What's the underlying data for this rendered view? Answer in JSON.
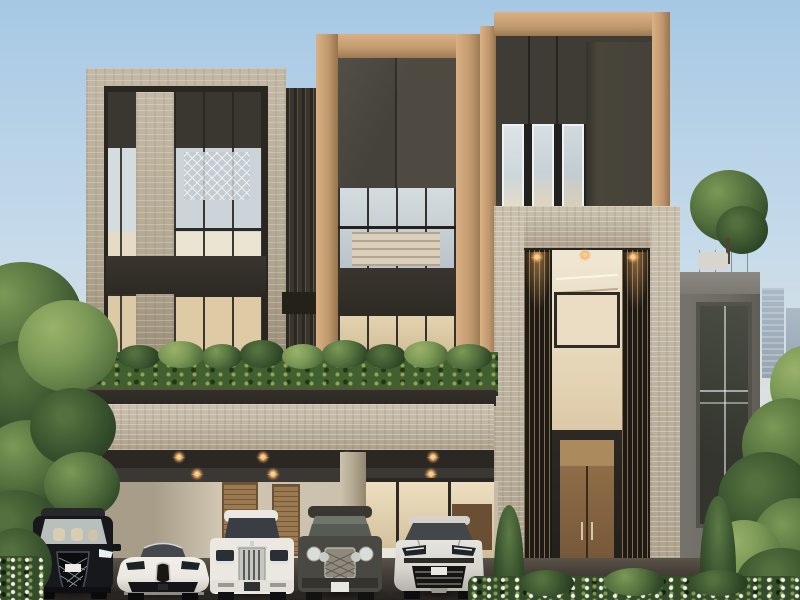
{
  "scene": {
    "title": "Modern three-storey luxury residence exterior with five luxury vehicles parked in the carport",
    "sky": "clear pale-blue daylight sky",
    "background": {
      "left_skyline": "distant high-rise city towers",
      "right_skyline": "distant high-rise city towers"
    },
    "residence": {
      "storeys": 3,
      "materials": [
        "beige concrete window frames",
        "travertine stone bands",
        "charcoal metal panels",
        "bronze metal pilasters",
        "full-height glazing with pale mullions",
        "black vertical slat screens"
      ],
      "features": [
        "left concrete-framed window tower with decorative lattice screen inside",
        "ribbed dark fin wall between towers",
        "bronze-framed central tower with dark panels and gridded windows",
        "bronze-trimmed dark right tower with triple vertical windows",
        "double-height travertine entrance portal",
        "vertical slat screens with warm accent lighting",
        "clipped rooftop hedge planter above carport",
        "travertine carport fascia with recessed warm downlights",
        "wood double entry door with steel pulls",
        "roof terrace at right with glass railing, white planter and tree"
      ]
    },
    "carport": {
      "downlight_count": 10,
      "entry_pendant_light_count": 3,
      "elements": [
        "beige rear wall",
        "wood louver shutters",
        "glazed kitchen wall with warm interior",
        "concrete column"
      ]
    },
    "vehicles": [
      {
        "name": "luxury-minivan",
        "style": "Lexus-LM-type minivan with spindle grille",
        "color": "black",
        "front_plate": "white, unreadable"
      },
      {
        "name": "hypercar",
        "style": "Bugatti-Chiron-type coupe with horseshoe grille",
        "color": "white"
      },
      {
        "name": "flagship-sedan",
        "style": "Rolls-Royce-Phantom-type sedan with chrome slat grille",
        "color": "white"
      },
      {
        "name": "luxury-suv",
        "style": "Bentley-Bentayga-type SUV with mesh grille and four round lamps",
        "color": "dark grey",
        "front_plate": "white, unreadable"
      },
      {
        "name": "performance-suv",
        "style": "Lamborghini-Urus-type SUV with angular lamps",
        "color": "white-silver",
        "front_plate": "white, unreadable"
      }
    ],
    "landscaping": [
      "large leafy tree at left foreground",
      "tall trees at right foreground",
      "hedge band above carport fascia",
      "two italian cypresses flanking the entrance",
      "white flowering groundcover bed at lower right",
      "low shrubs at lower left"
    ],
    "lighting": {
      "accent_lights_on": true,
      "style": "warm starburst downlights"
    }
  },
  "palette": {
    "sky_top": "#a6c8e4",
    "sky_mid": "#c7dbea",
    "sky_low": "#e6e3d5",
    "concrete": "#b3a893",
    "concrete_dark": "#988c76",
    "travertine": "#c9bfad",
    "travertine_dark": "#ab9f8a",
    "charcoal": "#3d3a34",
    "charcoal_dark": "#2a2722",
    "charcoal_light": "#4c4840",
    "bronze": "#c1996e",
    "bronze_light": "#dab184",
    "bronze_dark": "#96744e",
    "glass_cool": "#ccd6db",
    "glass_cool_dark": "#a3b2bb",
    "mullion_white": "#eef1f3",
    "glass_warm": "#e0cfae",
    "glass_warm_dark": "#c2ad8b",
    "wood_door": "#7f5f3e",
    "wood_shutter": "#9b7a52",
    "leaf": "#53703e",
    "leaf_dark": "#2f4727",
    "leaf_light": "#7b9956",
    "glow": "#f2a95c",
    "ground": "#47413a",
    "ground_dark": "#262320",
    "skyline": "#a2b1bf",
    "skyline_dark": "#8695a5",
    "wing": "#6d6b63",
    "wing_light": "#8b8981",
    "car_white": "#eae8e1",
    "car_black": "#17181c",
    "car_gray": "#4a4842",
    "car_silver": "#d8d6cf",
    "chrome": "#c6c7c1"
  }
}
